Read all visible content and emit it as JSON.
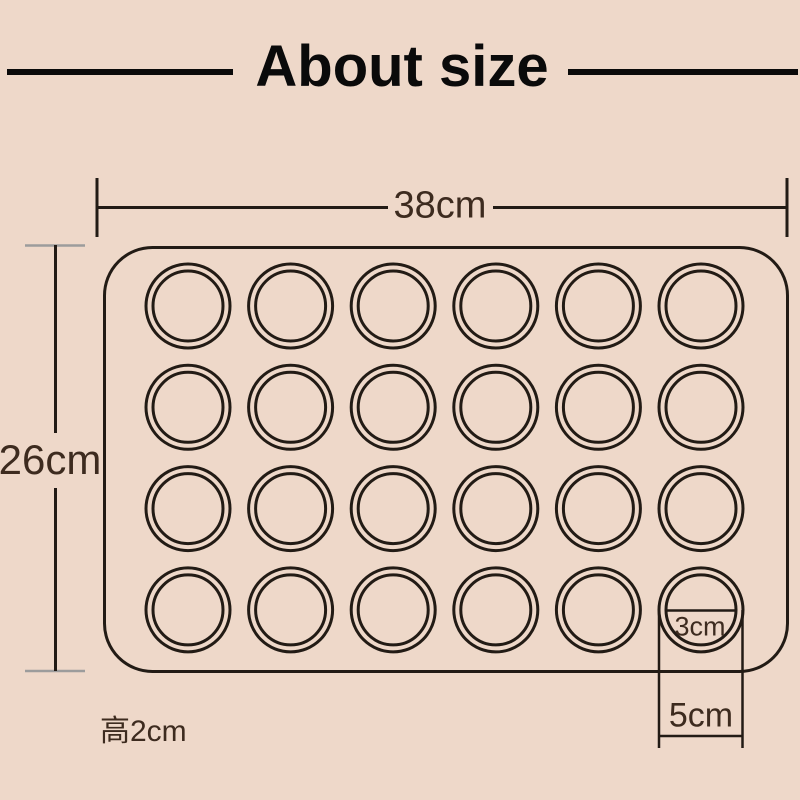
{
  "header": {
    "title": "About size"
  },
  "dimensions": {
    "mat_width": {
      "label": "38cm"
    },
    "mat_height": {
      "label": "26cm"
    },
    "cavity_inner_diameter": {
      "label": "3cm"
    },
    "cavity_outer_diameter": {
      "label": "5cm"
    },
    "mat_thickness": {
      "label": "高2cm"
    }
  },
  "mat": {
    "rows": 4,
    "columns": 6,
    "cavity_count": 24
  },
  "colors": {
    "background": "#eed8c9",
    "line": "#221b15",
    "label_text": "#3d2b1f",
    "height_dim_ticks": "#9c9c9c",
    "title_text": "#0a0a0a"
  }
}
